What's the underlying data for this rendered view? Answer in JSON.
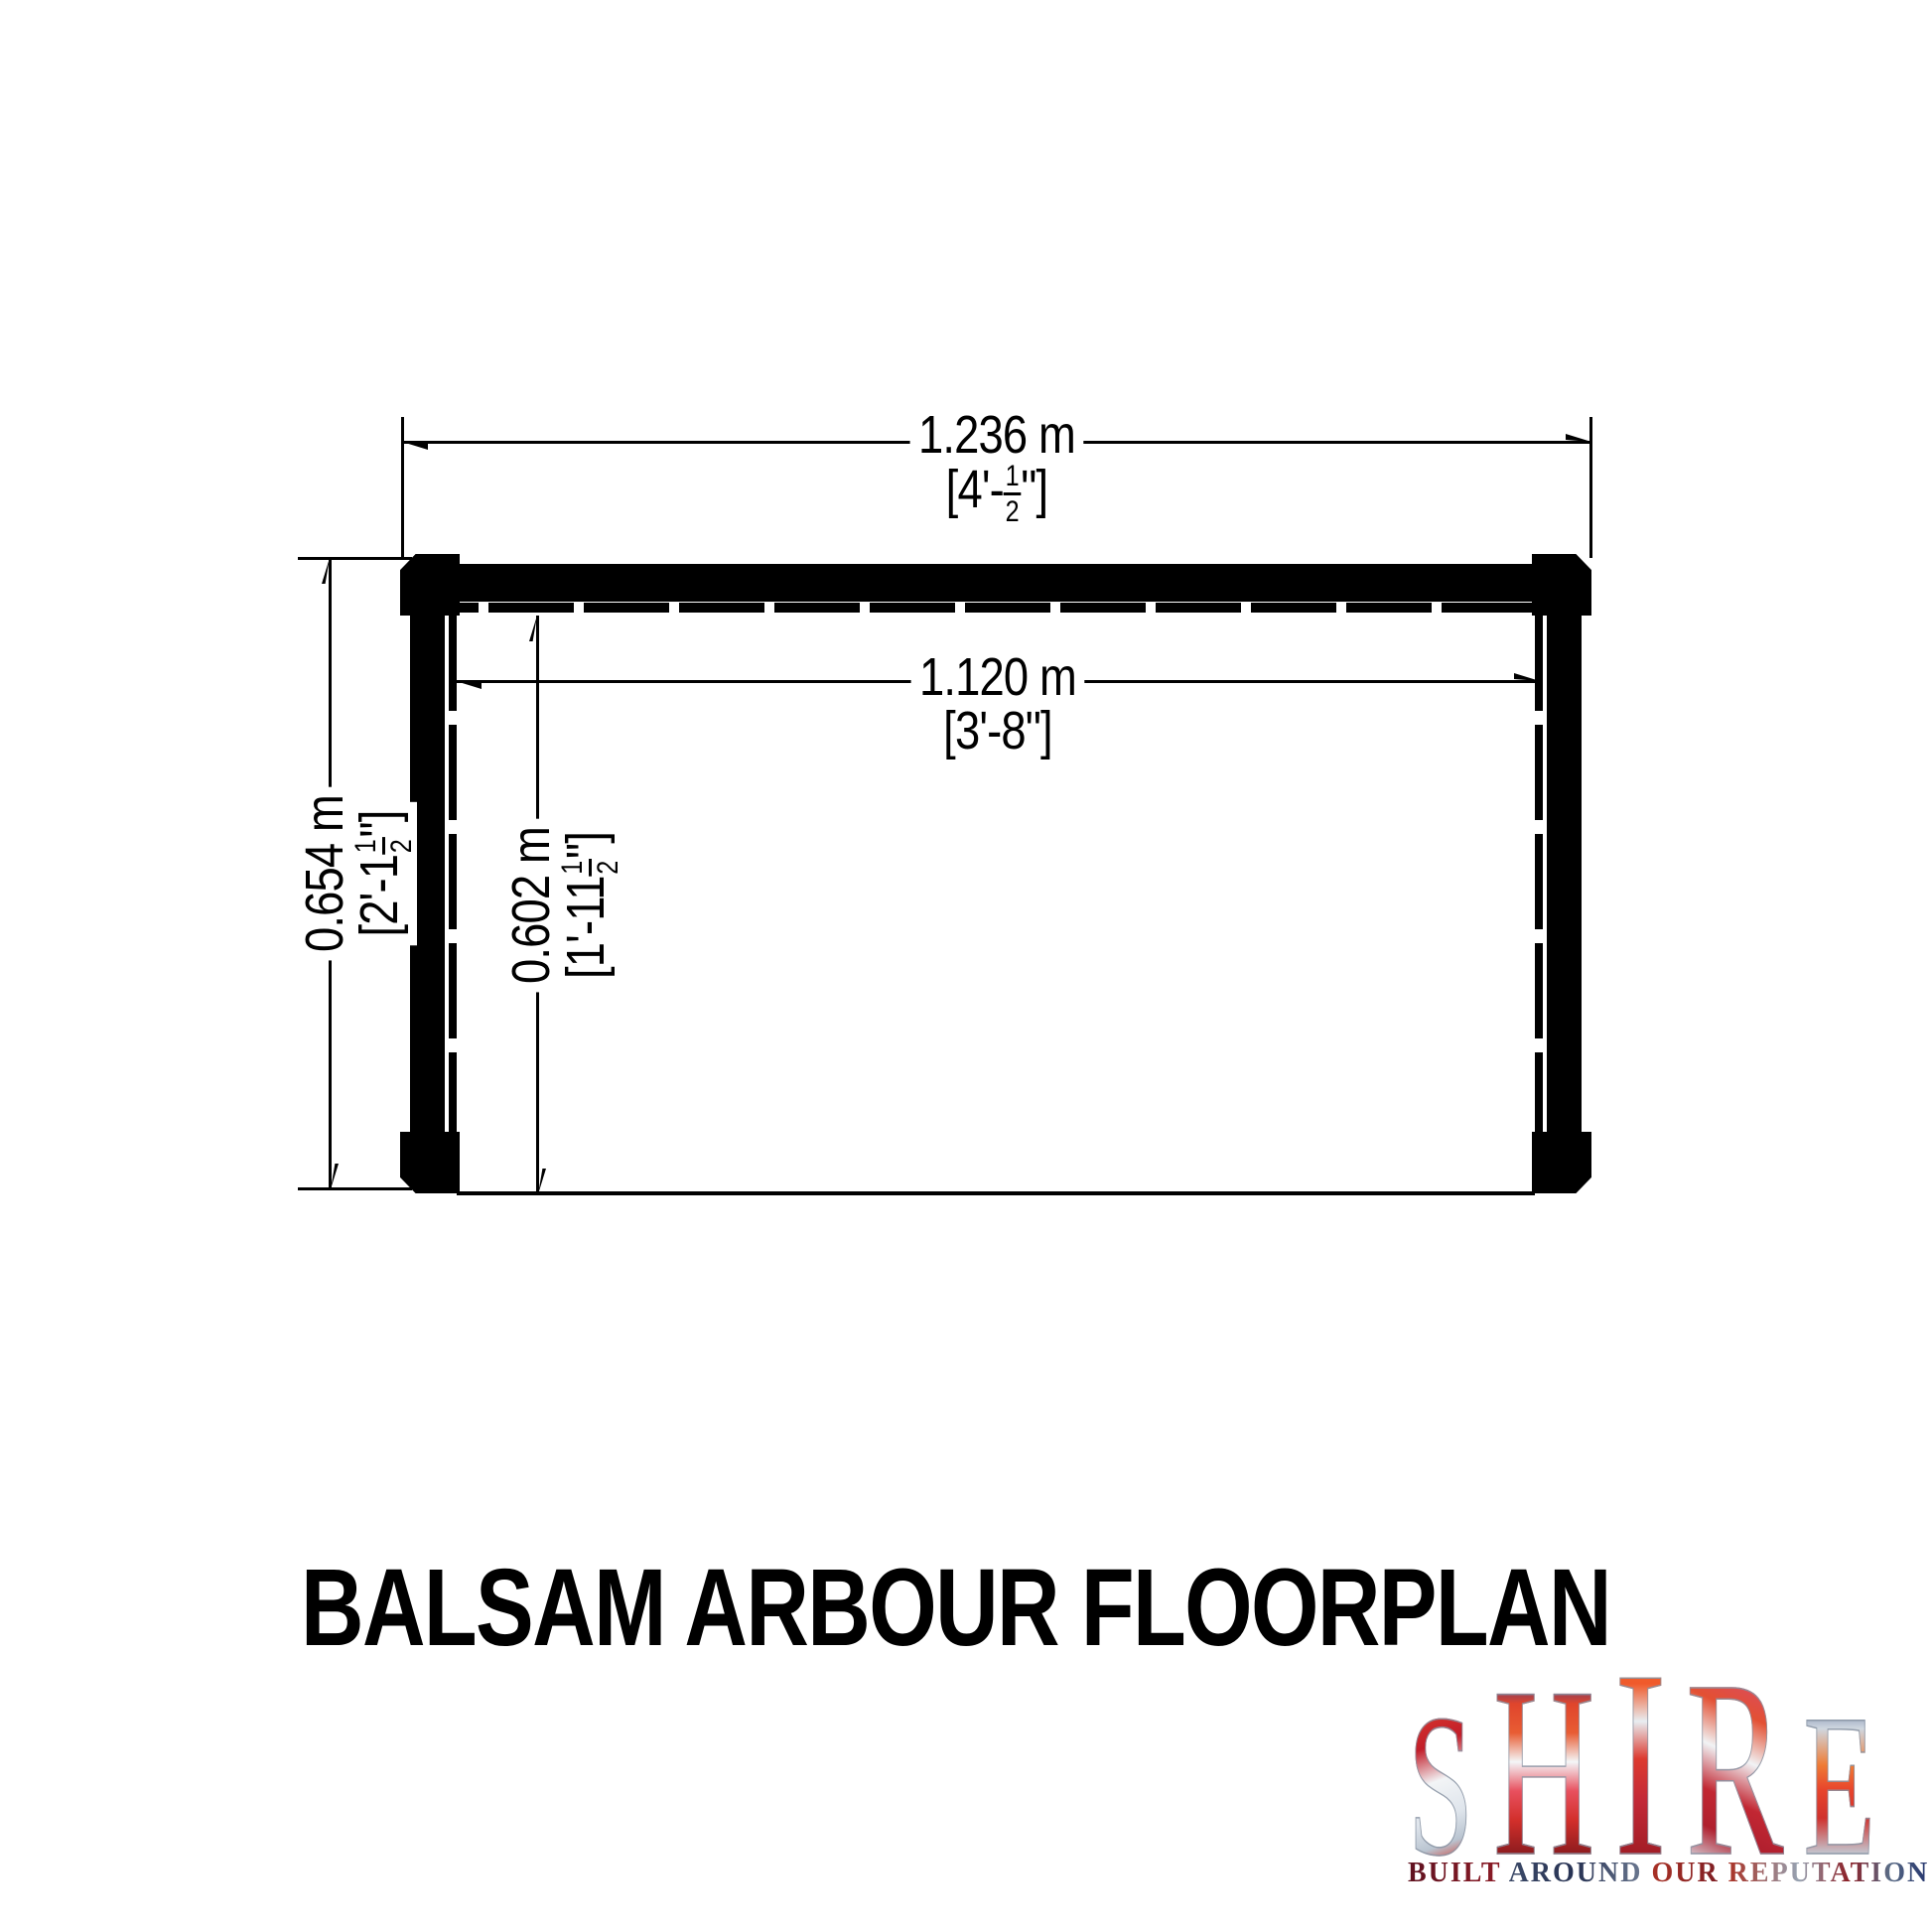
{
  "page": {
    "background": "#ffffff",
    "ink": "#000000"
  },
  "title": "BALSAM ARBOUR FLOORPLAN",
  "dimensions": {
    "overall_width": {
      "metric": "1.236 m",
      "imperial_prefix": "[4'-",
      "fraction_numerator": "1",
      "fraction_denominator": "2",
      "imperial_suffix": "\"]"
    },
    "inner_width": {
      "metric": "1.120 m",
      "imperial": "[3'-8\"]"
    },
    "overall_depth": {
      "metric": "0.654 m",
      "imperial_prefix": "[2'-1",
      "fraction_numerator": "1",
      "fraction_denominator": "2",
      "imperial_suffix": "\"]"
    },
    "inner_depth": {
      "metric": "0.602 m",
      "imperial_prefix": "[1'-11",
      "fraction_numerator": "1",
      "fraction_denominator": "2",
      "imperial_suffix": "\"]"
    }
  },
  "logo": {
    "letters": [
      {
        "char": "S"
      },
      {
        "char": "H"
      },
      {
        "char": "I"
      },
      {
        "char": "R"
      },
      {
        "char": "E"
      }
    ],
    "tagline_words": [
      {
        "text": "BUILT"
      },
      {
        "text": "AROUND"
      },
      {
        "text": "OUR"
      },
      {
        "text": "REPUTATION"
      }
    ],
    "colors": {
      "red": "#d0312d",
      "blue": "#1d3b8f",
      "silver": "#ccd4dd"
    }
  }
}
